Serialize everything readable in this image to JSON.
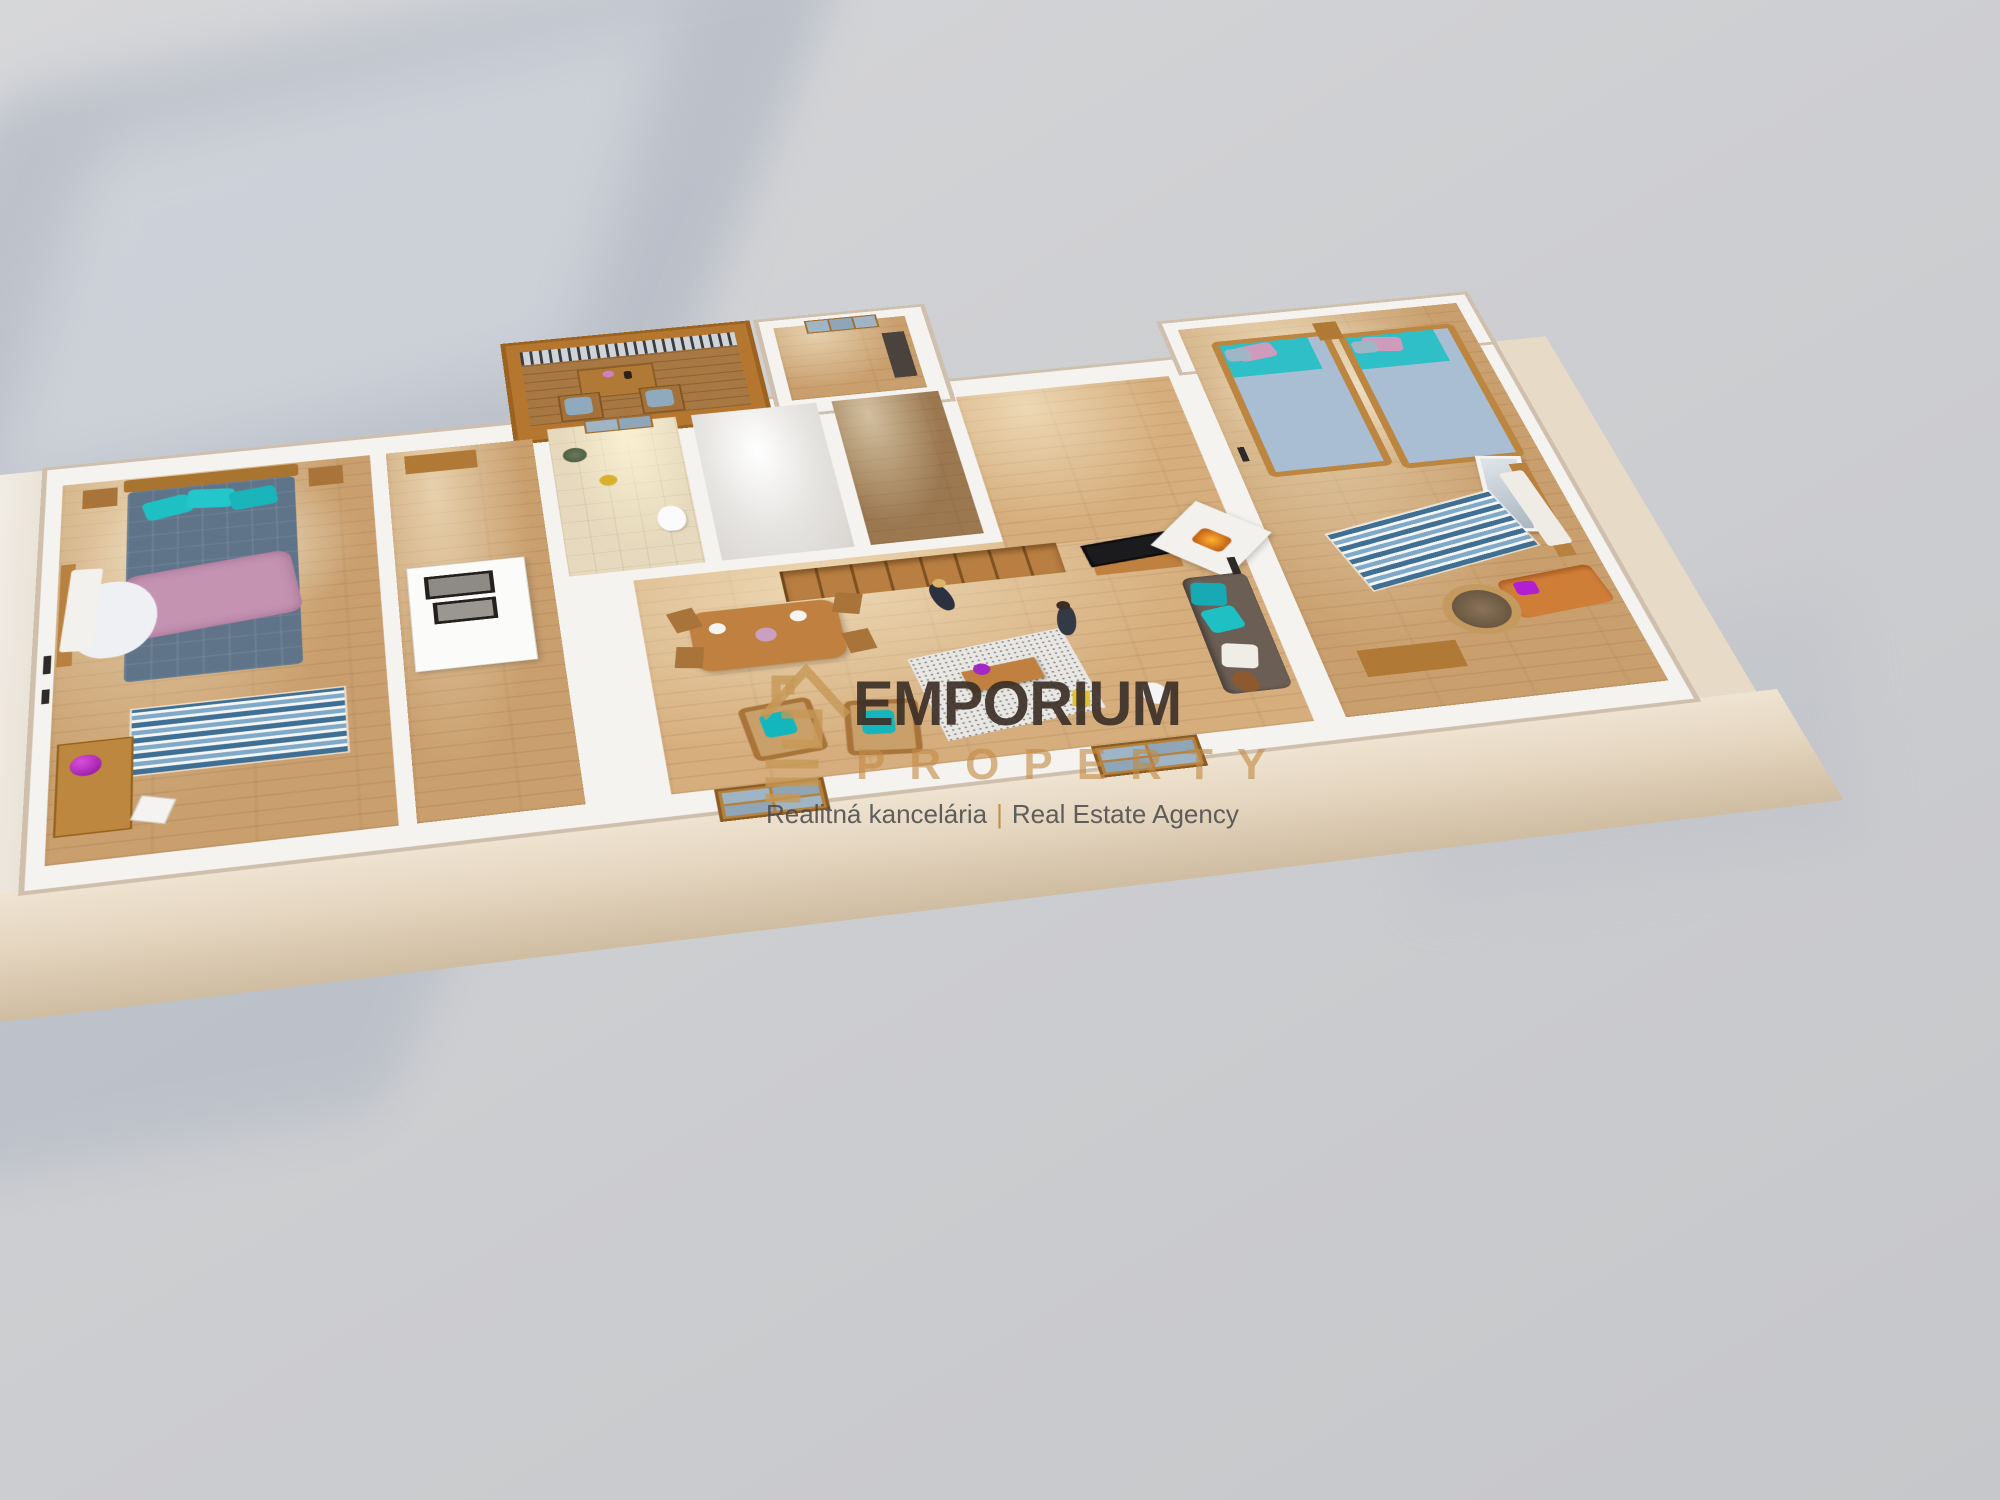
{
  "watermark": {
    "brand": "EMPORIUM",
    "brand_sub": "PROPERTY",
    "tagline_left": "Realitná kancelária",
    "tagline_separator": "|",
    "tagline_right": "Real Estate Agency",
    "logo_icon": "emporium-house-logo"
  },
  "colors": {
    "background_gray": "#cecfd2",
    "cast_shadow": "#a9b1c0",
    "wall_white": "#f5f3f0",
    "wall_trim_beige": "#cfc0ae",
    "facade_cream": "#e4d5bf",
    "balcony_orange": "#b5772f",
    "floor_wood": "#c99f6e",
    "floor_tile": "#e6d9bd",
    "brand_text_brown": "#3C3027",
    "brand_gold": "#C18A45",
    "tagline_gray": "#484848",
    "accent_teal": "#1FC0C4",
    "duvet_blue": "#5F7489",
    "blanket_pink": "#C493B2",
    "rug_blue": "#3F6F93"
  }
}
